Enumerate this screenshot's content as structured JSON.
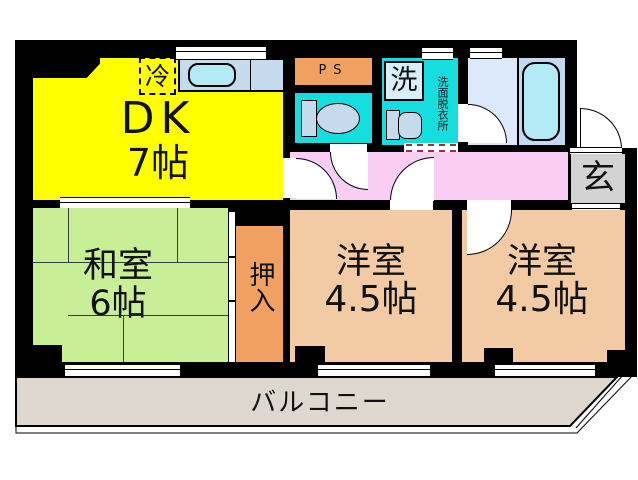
{
  "rooms": {
    "dk": {
      "label": "DK",
      "size": "7帖"
    },
    "washitsu": {
      "label": "和室",
      "size": "6帖"
    },
    "oshiire": {
      "label": "押入"
    },
    "western_left": {
      "label": "洋室",
      "size": "4.5帖"
    },
    "western_right": {
      "label": "洋室",
      "size": "4.5帖"
    },
    "balcony": {
      "label": "バルコニー"
    },
    "genkan": {
      "label": "玄"
    }
  },
  "fixtures": {
    "ps": {
      "label": "PS"
    },
    "fridge": {
      "label": "冷"
    },
    "washer": {
      "label": "洗"
    },
    "washroom": {
      "label": "洗面脱衣所"
    },
    "shoebox": {
      "label": "靴箱"
    }
  },
  "colors": {
    "wall": "#000000",
    "dk": "#ffff00",
    "washitsu": "#c9ef96",
    "oshiire": "#f0a060",
    "western": "#f2cba4",
    "hallway": "#f9cdf4",
    "wet_area": "#16dede",
    "bathroom": "#dce9fa",
    "bathtub": "#b4e9f6",
    "kitchen_counter": "#c6daee",
    "genkan": "#d3d3d3",
    "shoebox": "#f0a060",
    "ps": "#f0a060",
    "balcony": "#ded7cf"
  }
}
